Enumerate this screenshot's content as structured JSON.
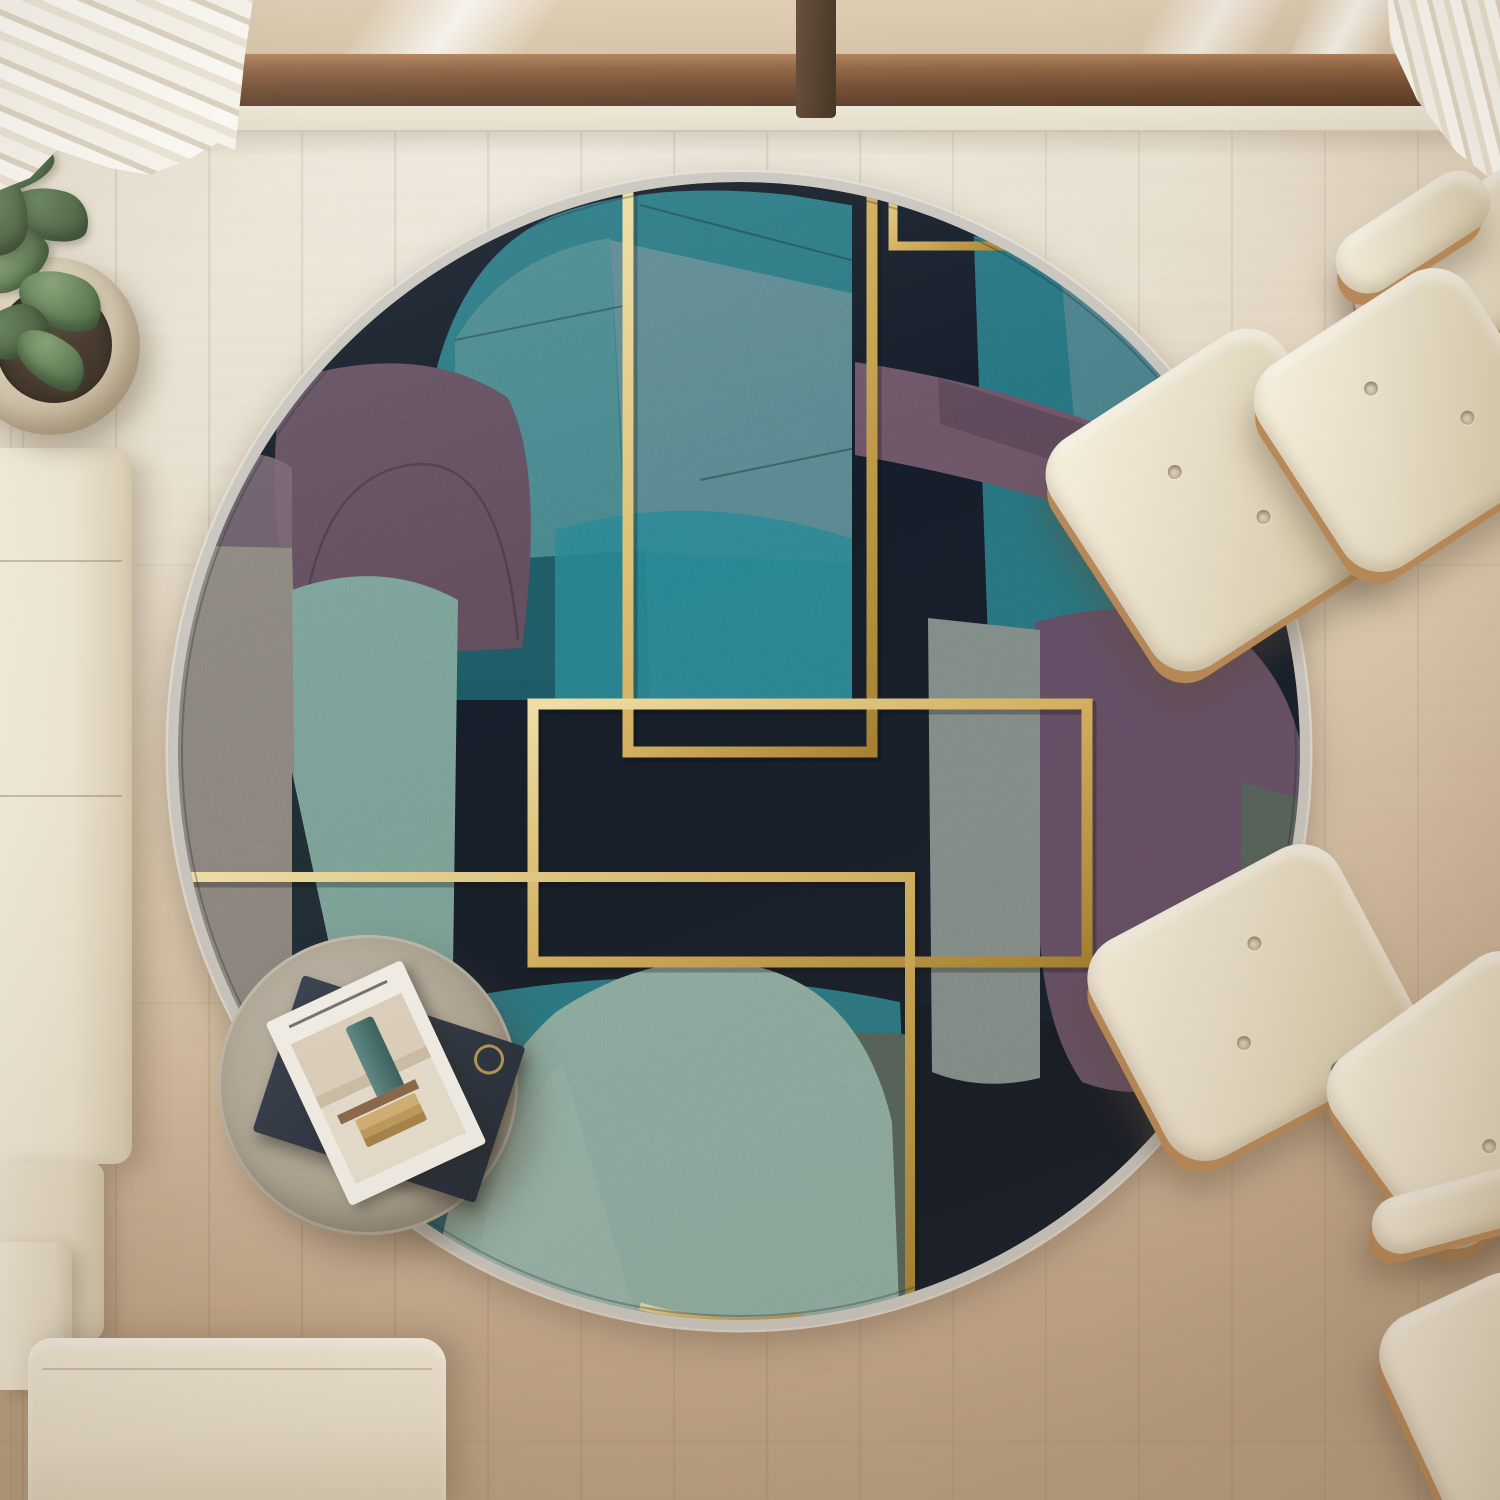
{
  "scene": {
    "description": "Top-down view of a living room: round abstract art-deco rug with gold lines, cream boucle sofa, two Eames-style lounge chairs with ottomans, round concrete side table with magazines, potted plant, sheer curtains and window sill on light wood flooring",
    "side_table": {
      "magazine_title": "OLIV"
    }
  },
  "palette": {
    "floor_light": "#f1ece1",
    "floor_warm": "#c4aa8d",
    "window_glass": "#dcc9ae",
    "window_frame": "#6d452a",
    "window_frame_dark": "#47331f",
    "curtain": "#f8f5ed",
    "sofa_cream": "#ece4d0",
    "leather_cream": "#e8dfc8",
    "wood_trim": "#b98a58",
    "chrome": "#8c8c8c",
    "table_concrete": "#aea695",
    "magazine_dark": "#2c3542",
    "magazine_gold": "#c2a055",
    "magazine_white": "#f4f1ea",
    "macaron": "#c9793f",
    "soil": "#33261b",
    "leaf": "#57774c",
    "leaf_dark": "#46613d",
    "rug_navy": "#17212e",
    "rug_teal": "#2d8591",
    "rug_teal_bright": "#2f96a5",
    "rug_teal_deep": "#1d5f6d",
    "rug_sage": "#9abdb1",
    "rug_sage_band": "#89b2a8",
    "rug_grayblue": "#93a4ab",
    "rug_gray_warm": "#9a948c",
    "rug_sagegray": "#8f9c99",
    "rug_graygreen": "#5c6c63",
    "rug_purple": "#6d5670",
    "rug_purple_band": "#7a5e73",
    "rug_plum": "#4e4354",
    "rug_mauve": "#6d5769",
    "rug_mauve_light": "#84707f",
    "rug_slate": "#22323b",
    "rug_binding": "#c9c6bf",
    "gold": "#d4b260",
    "gold_light": "#f0e0a8",
    "gold_dark": "#a88332"
  }
}
